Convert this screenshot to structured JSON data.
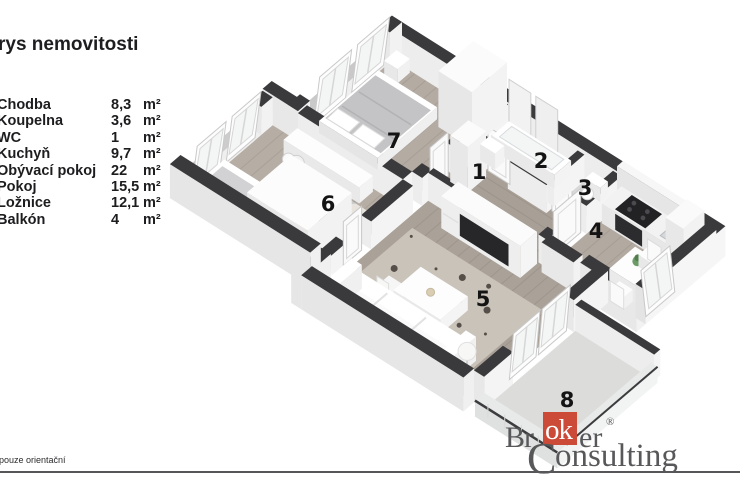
{
  "title": "rys nemovitosti",
  "legend": [
    {
      "name": "Chodba",
      "value": "8,3",
      "unit": "m²"
    },
    {
      "name": "Koupelna",
      "value": "3,6",
      "unit": "m²"
    },
    {
      "name": "WC",
      "value": "1",
      "unit": "m²"
    },
    {
      "name": "Kuchyň",
      "value": "9,7",
      "unit": "m²"
    },
    {
      "name": "Obývací pokoj",
      "value": "22",
      "unit": "m²"
    },
    {
      "name": "Pokoj",
      "value": "15,5",
      "unit": "m²"
    },
    {
      "name": "Ložnice",
      "value": "12,1",
      "unit": "m²"
    },
    {
      "name": "Balkón",
      "value": "4",
      "unit": "m²"
    }
  ],
  "plan": {
    "room_numbers": [
      "1",
      "2",
      "3",
      "4",
      "5",
      "6",
      "7",
      "8"
    ]
  },
  "footnote": "pouze orientační",
  "logo": {
    "pre": "Br",
    "boxed": "ok",
    "post": "er",
    "reg": "®",
    "line2_initial": "C",
    "line2_rest": "onsulting"
  },
  "colors": {
    "wall_top": "#3a3a3c",
    "wood_floor": "#b2a9a0",
    "hall_floor": "#a89f96",
    "living_floor": "#aaa198",
    "tile_floor": "#d8d8d8",
    "balcony_floor": "#dcdcda",
    "rug_living": "#c9c3b9",
    "logo_red": "#cc4b38",
    "logo_gray": "#58585a"
  }
}
